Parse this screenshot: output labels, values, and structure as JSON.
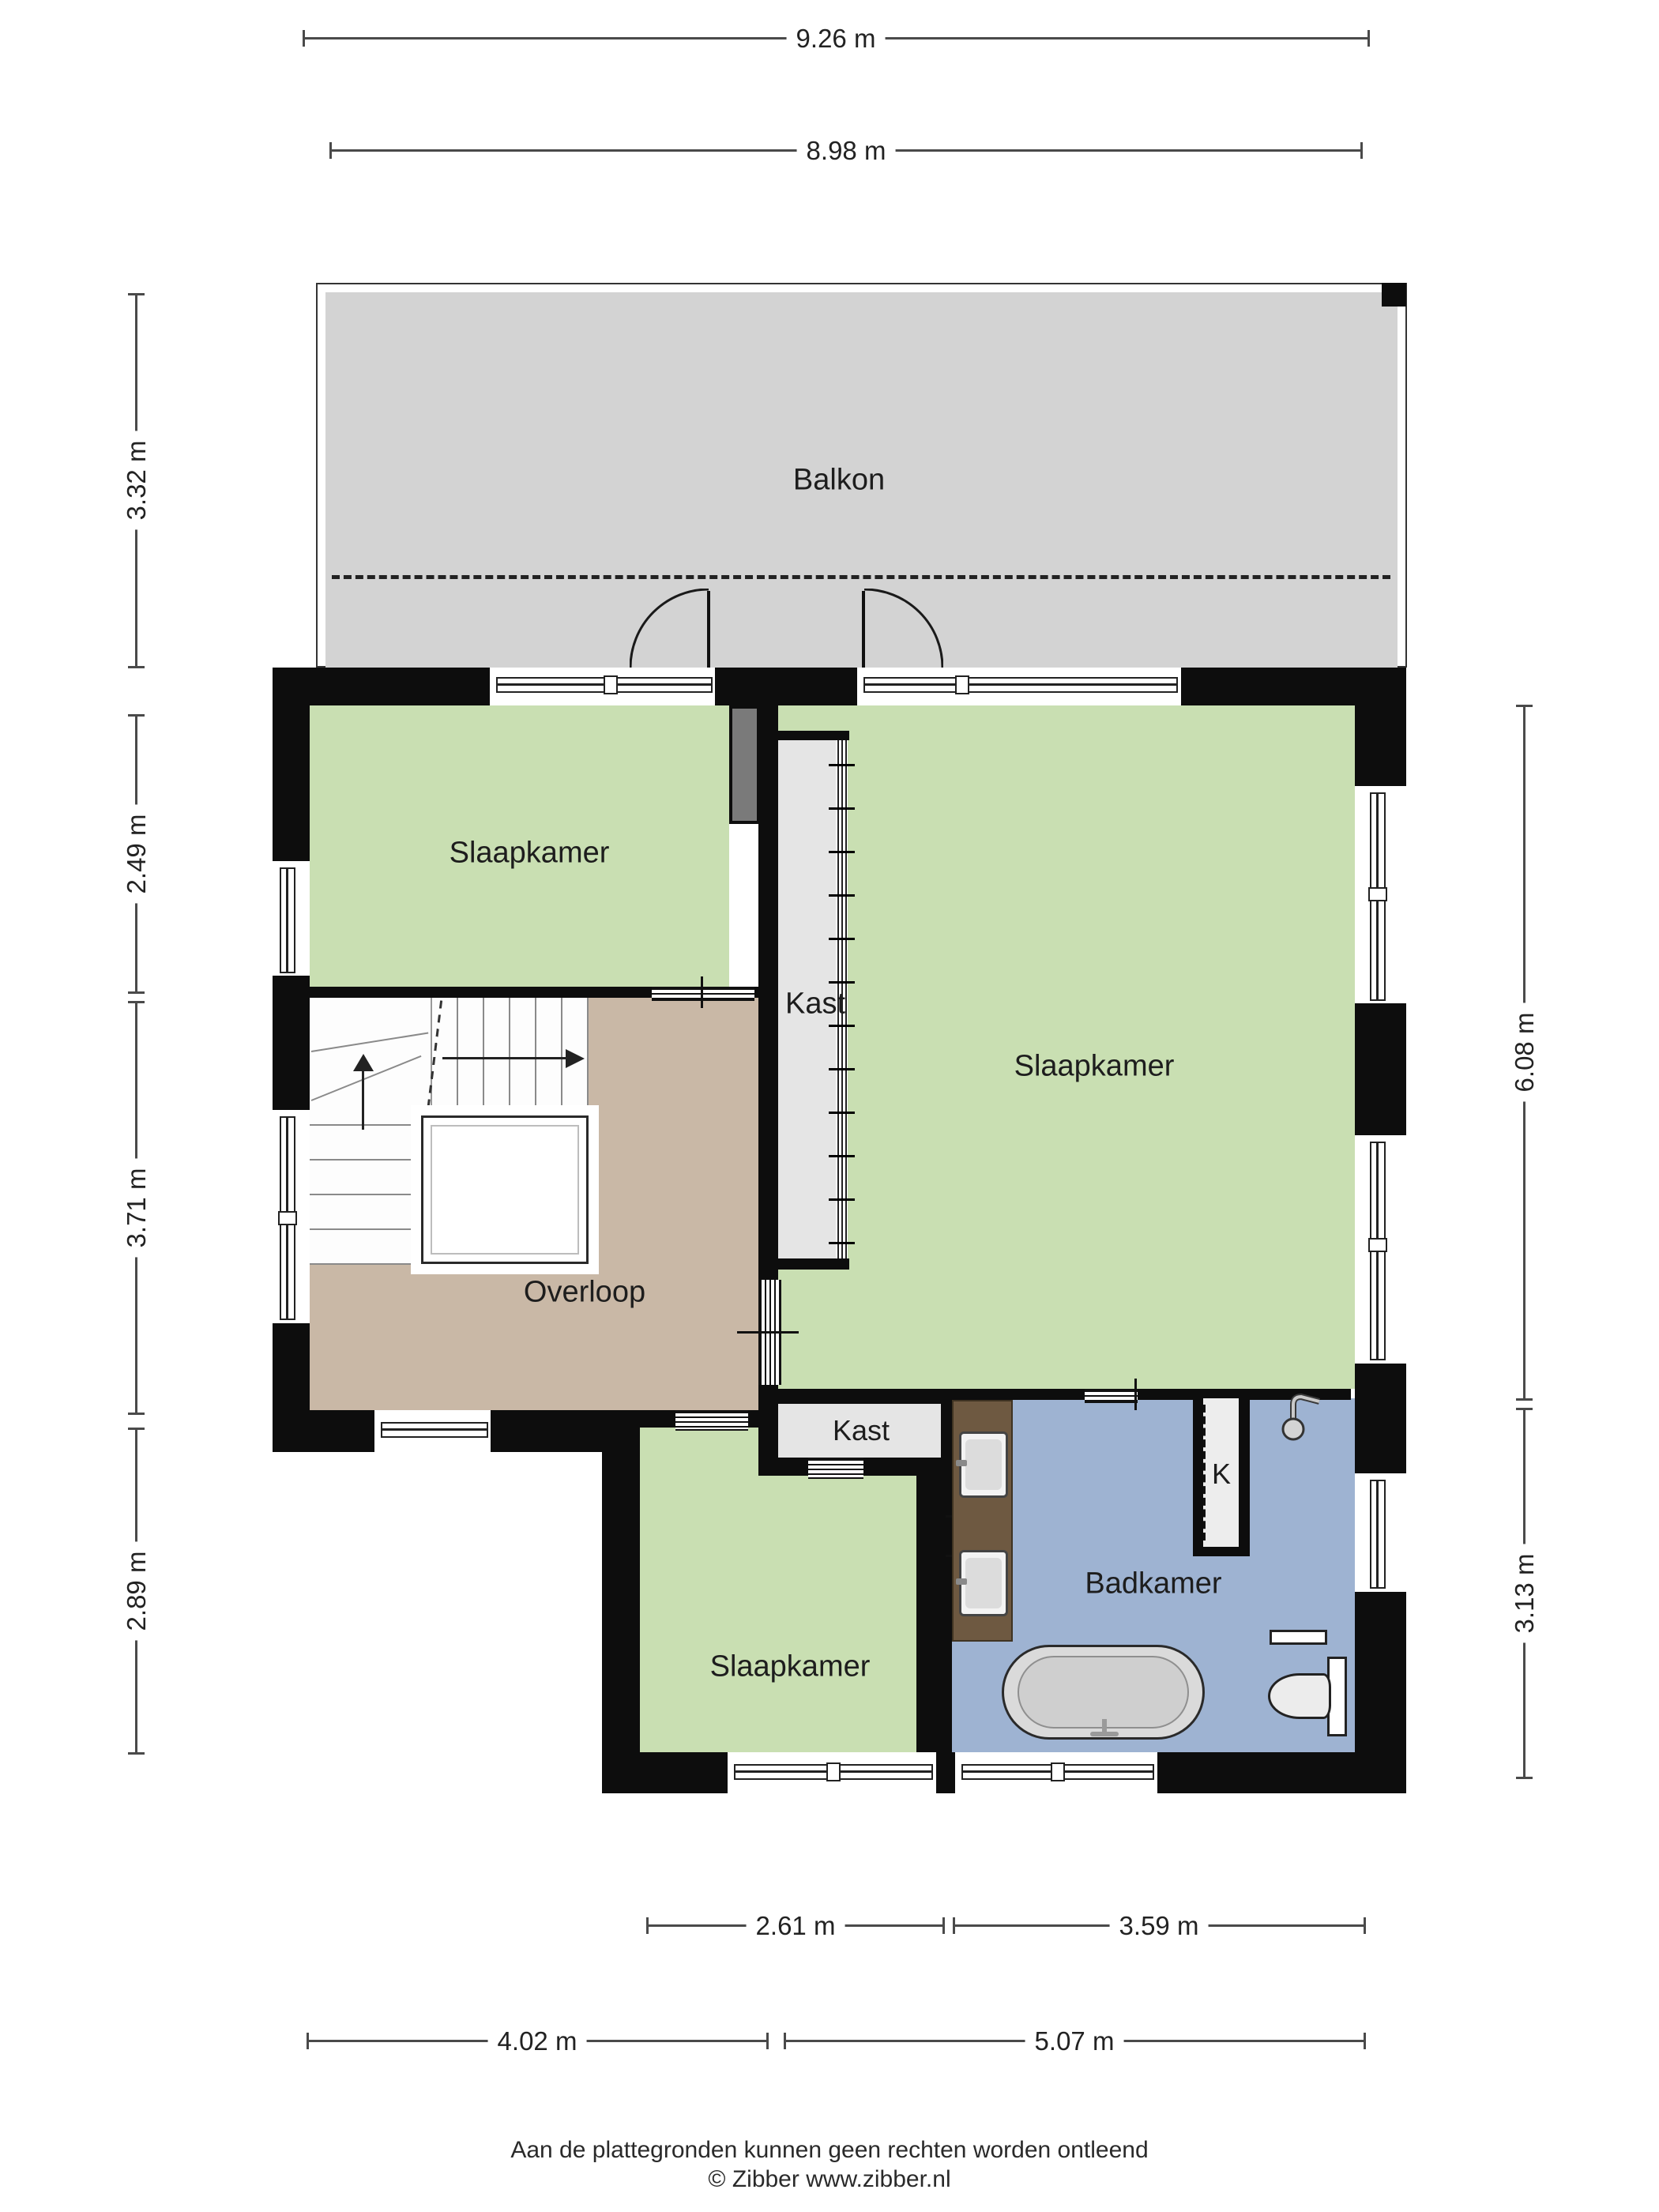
{
  "meta": {
    "type": "floorplan",
    "provider_note": "Zibber floor plan, first floor (verdieping)"
  },
  "colors": {
    "wall": "#0d0d0d",
    "bedroom_green": "#c9dfb2",
    "hall_tan": "#c9b8a6",
    "balcony_gray": "#d3d3d3",
    "closet_gray": "#e5e5e5",
    "bathroom_blue": "#9eb3d2",
    "vanity_wood": "#6e5941",
    "chimney_gray": "#7a7a7a",
    "dimension_line": "#4a4a4a"
  },
  "rooms": {
    "balkon": {
      "label": "Balkon"
    },
    "slaapkamer_tl": {
      "label": "Slaapkamer"
    },
    "kast_tall": {
      "label": "Kast"
    },
    "slaapkamer_right": {
      "label": "Slaapkamer"
    },
    "overloop": {
      "label": "Overloop"
    },
    "kast_small": {
      "label": "Kast"
    },
    "slaapkamer_bottom": {
      "label": "Slaapkamer"
    },
    "badkamer": {
      "label": "Badkamer"
    },
    "k_closet": {
      "label": "K"
    }
  },
  "dimensions": {
    "top": [
      "9.26 m",
      "8.98 m"
    ],
    "left": [
      "3.32 m",
      "2.49 m",
      "3.71 m",
      "2.89 m"
    ],
    "right": [
      "6.08 m",
      "3.13 m"
    ],
    "bottom_inner": [
      "2.61 m",
      "3.59 m"
    ],
    "bottom_outer": [
      "4.02 m",
      "5.07 m"
    ]
  },
  "footer": {
    "disclaimer": "Aan de plattegronden kunnen geen rechten worden ontleend",
    "copyright": "© Zibber www.zibber.nl"
  }
}
